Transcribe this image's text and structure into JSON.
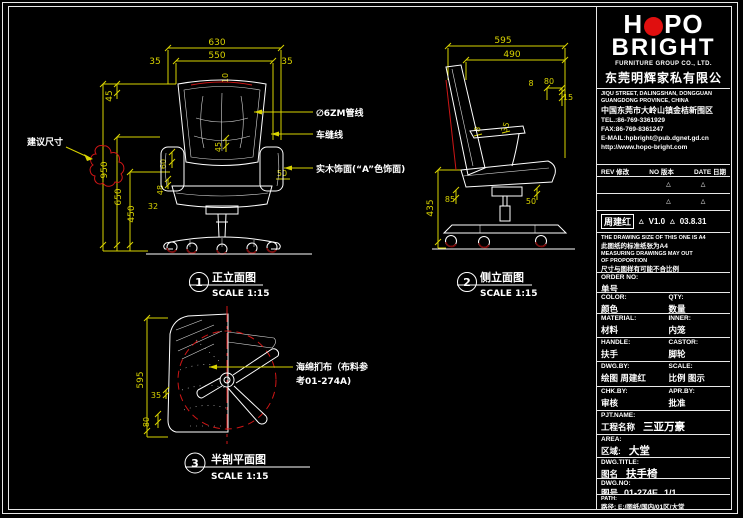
{
  "colors": {
    "background": "#000000",
    "line_white": "#ffffff",
    "dim_yellow": "#d9d300",
    "accent_red": "#cf1616",
    "wheel_dark_red": "#7c0808",
    "logo_red": "#e00f0f"
  },
  "titleblock": {
    "logo": {
      "word1_a": "H",
      "word1_b": "PO",
      "word2": "BRIGHT",
      "subtitle": "FURNITURE GROUP CO., LTD.",
      "company_cn": "东莞明辉家私有限公司"
    },
    "address": {
      "line1": "JIQU STREET, DALINGSHAN, DONGGUAN",
      "line2": "GUANGDONG PROVINCE, CHINA",
      "line3": "中国东莞市大岭山镇金桔新围区",
      "tel": "TEL.:86-769-3361929",
      "fax": "FAX:86-769-8361247",
      "email": "E-MAIL:hpbright@pub.dgnet.gd.cn",
      "web": "http://www.hopo-bright.com"
    },
    "revision": {
      "rev": "REV 修改",
      "no": "NO 版本",
      "date": "DATE 日期",
      "mark": "△",
      "row": {
        "name": "周建红",
        "version": "V1.0",
        "date": "03.8.31"
      }
    },
    "note": {
      "l1": "THE DRAWING SIZE OF THIS ONE IS A4",
      "l2": "此图纸的标准纸张为A4",
      "l3": "MEASURING DRAWINGS MAY OUT",
      "l4": "OF PROPORTION",
      "l5": "尺寸与图样有可能不合比例"
    },
    "fields": {
      "order": {
        "en": "ORDER NO:",
        "cn": "单号"
      },
      "color": {
        "en": "COLOR:",
        "cn": "颜色"
      },
      "qty": {
        "en": "QTY:",
        "cn": "数量"
      },
      "material": {
        "en": "MATERIAL:",
        "cn": "材料"
      },
      "inner": {
        "en": "INNER:",
        "cn": "内笼"
      },
      "handle": {
        "en": "HANDLE:",
        "cn": "扶手"
      },
      "castor": {
        "en": "CASTOR:",
        "cn": "脚轮"
      },
      "dwgby": {
        "en": "DWG.BY:",
        "cn": "绘图",
        "value": "周建红"
      },
      "scale": {
        "en": "SCALE:",
        "cn": "比例",
        "value": "图示"
      },
      "chkby": {
        "en": "CHK.BY:",
        "cn": "审核"
      },
      "aprby": {
        "en": "APR.BY:",
        "cn": "批准"
      },
      "pjt": {
        "en": "PJT.NAME:",
        "cn": "工程名称",
        "value": "三亚万豪"
      },
      "area": {
        "en": "AREA:",
        "cn": "区域:",
        "value": "大堂"
      },
      "dtitle": {
        "en": "DWG.TITLE:",
        "cn": "图名",
        "value": "扶手椅"
      },
      "dno": {
        "en": "DWG.NO:",
        "cn": "图号",
        "value": "01-274E",
        "page": "1/1"
      },
      "path": {
        "en": "PATH:",
        "cn": "路径:",
        "value": "E:/图纸/国内/01区/大堂"
      }
    }
  },
  "views": {
    "front": {
      "number": "1",
      "title": "正立面图",
      "scale": "SCALE 1:15",
      "dims": {
        "overall_width": "630",
        "inner_width": "550",
        "margin_left": "35",
        "margin_right": "35",
        "back_top": "45",
        "overall_height": "950",
        "arm_height": "650",
        "seat_height": "450",
        "d60": "60",
        "d48": "48",
        "d32": "32",
        "d10": "10",
        "d45": "45",
        "d50": "50"
      },
      "callouts": {
        "suggest": "建议尺寸",
        "tube": "∅6ZM管线",
        "stitch": "车缝线",
        "wood": "实木饰面(“A”色饰面)"
      }
    },
    "side": {
      "number": "2",
      "title": "侧立面图",
      "scale": "SCALE 1:15",
      "dims": {
        "overall_depth": "595",
        "seat_depth": "490",
        "d8a": "8",
        "d80": "80",
        "d15": "15",
        "d8b": "8",
        "d35": "35",
        "seat_height": "435",
        "d85": "85",
        "d50": "50"
      }
    },
    "section": {
      "number": "3",
      "title": "半剖平面图",
      "scale": "SCALE 1:15",
      "dims": {
        "depth": "595",
        "d35": "35",
        "d80": "80"
      },
      "callout_line1": "海绵扪布（布料参",
      "callout_line2": "考01-274A)"
    }
  }
}
